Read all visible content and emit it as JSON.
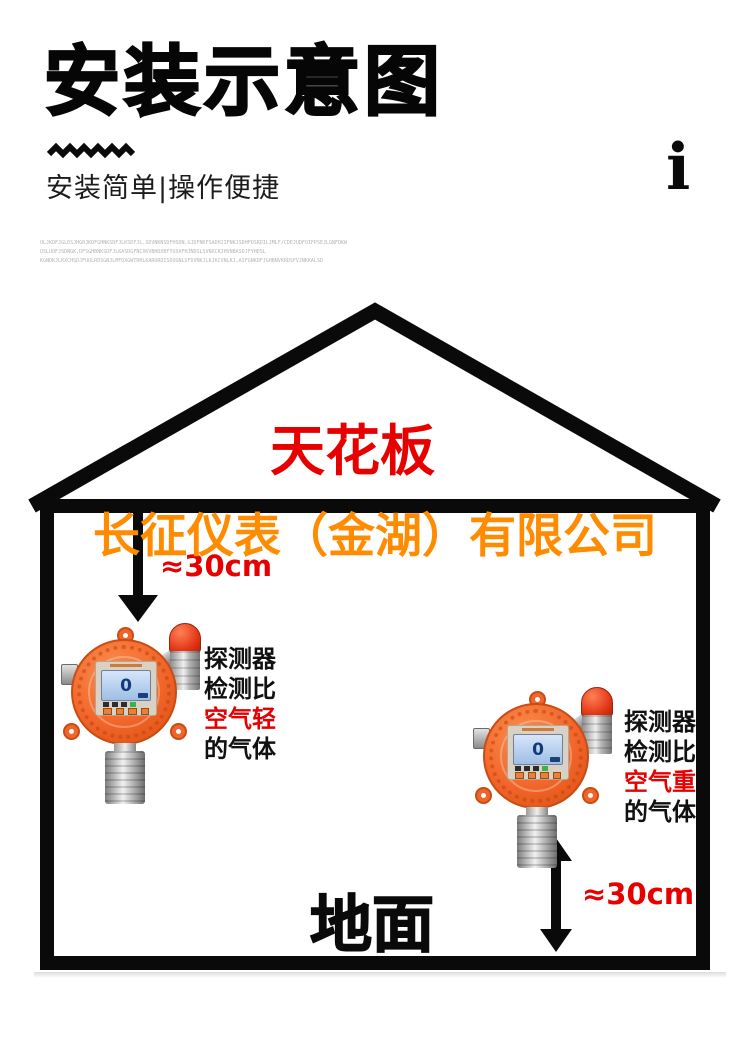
{
  "header": {
    "title": "安装示意图",
    "subtitle": "安装简单|操作便捷",
    "info_mark": "i",
    "fine_print": [
      "OLJKDFJGLDSJHG0JKDFGHNKSDFJLKSDFJL,SDVNKNSDFHSDN,GJDFNKFSADHJIFNKJSDHFOSRDILJMLF/CDEJUDFOIFPSEJLGNFDKW",
      "OSLUOFJSDNGK,DFSGHBNKSDFJLKASDGFNCXKVBHDXBFYUXAFHJNDSLSVNXCKJHVNBASDJFYHDSL",
      "KGNDKJLKXCHSDJFUULRDSGNJLMFDXGWTRHLKARUROISDUGNLSFDVNKJLKJKCVNLKJ,ASFGNKDFJGHBNVKRDSFVJNKKALSD"
    ]
  },
  "diagram": {
    "ceiling_label": "天花板",
    "watermark": "长征仪表（金湖）有限公司",
    "ground_label": "地面",
    "lcd_value": "0",
    "left_annotation": {
      "distance": "≈30cm",
      "lines": {
        "l1": "探测器",
        "l2": "检测比",
        "l3": "空气轻",
        "l4": "的气体"
      }
    },
    "right_annotation": {
      "distance": "≈30cm",
      "lines": {
        "l1": "探测器",
        "l2": "检测比",
        "l3": "空气重",
        "l4": "的气体"
      }
    }
  },
  "colors": {
    "accent_red": "#e60000",
    "brand_orange": "#ff8c00",
    "device_orange": "#f2652a",
    "outline_black": "#0a0a0a"
  }
}
